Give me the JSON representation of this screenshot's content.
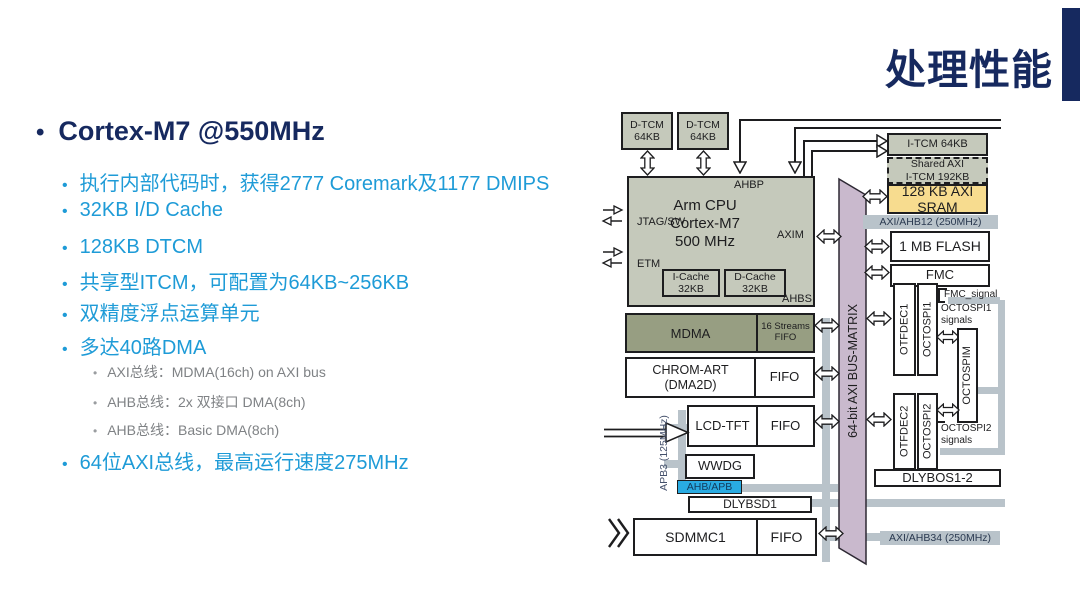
{
  "title": "处理性能",
  "colors": {
    "accent_navy": "#16295f",
    "bullet_blue": "#1e9bd7",
    "sub_gray": "#7f8285",
    "box_gray": "#c5c9bb",
    "mdma_olive": "#979e82",
    "sram_yellow": "#f7dc8f",
    "bus_gray": "#b9c3ca",
    "matrix_purple": "#c9b9cd",
    "ahb_apb_blue": "#29abe2"
  },
  "left_panel": {
    "heading": "Cortex-M7 @550MHz",
    "items": [
      {
        "level": 2,
        "text": "执行内部代码时，获得2777 Coremark及1177 DMIPS"
      },
      {
        "level": 2,
        "text": "32KB I/D Cache"
      },
      {
        "level": 2,
        "text": "128KB DTCM"
      },
      {
        "level": 2,
        "text": "共享型ITCM，可配置为64KB~256KB"
      },
      {
        "level": 2,
        "text": "双精度浮点运算单元"
      },
      {
        "level": 2,
        "text": "多达40路DMA"
      },
      {
        "level": 3,
        "text": "AXI总线：MDMA(16ch) on AXI bus"
      },
      {
        "level": 3,
        "text": "AHB总线：2x 双接口 DMA(8ch)"
      },
      {
        "level": 3,
        "text": "AHB总线：Basic DMA(8ch)"
      },
      {
        "level": 2,
        "text": "64位AXI总线，最高运行速度275MHz"
      }
    ]
  },
  "diagram": {
    "dtcm1": "D-TCM\n64KB",
    "dtcm2": "D-TCM\n64KB",
    "ahbp": "AHBP",
    "cpu_line1": "Arm  CPU",
    "cpu_line2": "Cortex-M7",
    "cpu_line3": "500 MHz",
    "jtag": "JTAG/SW",
    "etm": "ETM",
    "axim": "AXIM",
    "ahbs": "AHBS",
    "icache": "I-Cache\n32KB",
    "dcache": "D-Cache\n32KB",
    "itcm": "I-TCM 64KB",
    "shared_itcm": "Shared AXI\nI-TCM 192KB",
    "axi_sram": "128 KB AXI\nSRAM",
    "bus12": "AXI/AHB12 (250MHz)",
    "flash": "1 MB FLASH",
    "fmc": "FMC",
    "fmc_signal": "FMC_signal",
    "otfdec1": "OTFDEC1",
    "octospi1": "OCTOSPI1",
    "octospi1_signals": "OCTOSPI1\nsignals",
    "octospim": "OCTOSPIM",
    "otfdec2": "OTFDEC2",
    "octospi2": "OCTOSPI2",
    "octospi2_signals": "OCTOSPI2\nsignals",
    "dlybos": "DLYBOS1-2",
    "bus34": "AXI/AHB34 (250MHz)",
    "matrix": "64-bit AXI BUS-MATRIX",
    "mdma": "MDMA",
    "mdma_fifo": "16 Streams\nFIFO",
    "chromart": "CHROM-ART\n(DMA2D)",
    "fifo1": "FIFO",
    "lcdtft": "LCD-TFT",
    "fifo2": "FIFO",
    "wwdg": "WWDG",
    "ahb_apb": "AHB/APB",
    "dlybsd1": "DLYBSD1",
    "sdmmc1": "SDMMC1",
    "fifo3": "FIFO",
    "apb3": "APB3 (125MHz)"
  }
}
